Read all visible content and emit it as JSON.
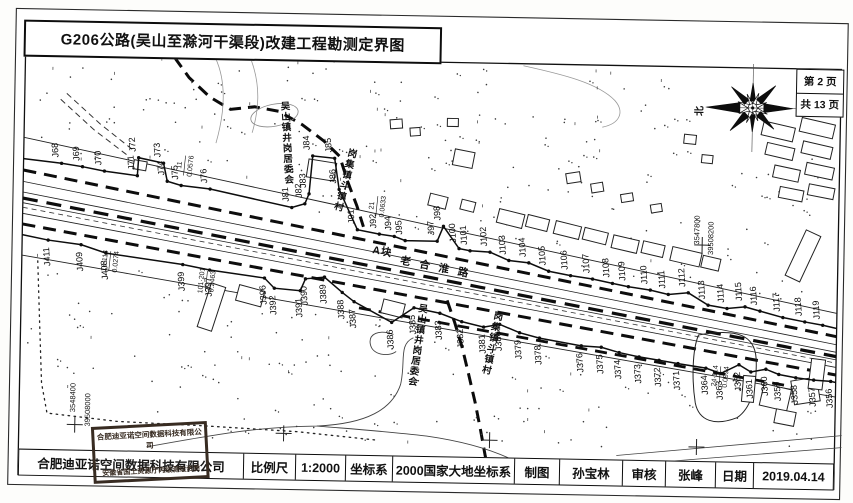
{
  "title": "G206公路(吴山至滁河干渠段)改建工程勘测定界图",
  "page_info": {
    "page": "第 2 页",
    "total": "共 13 页"
  },
  "north_label": "北",
  "footer": {
    "company": "合肥迪亚诺空间数据科技有限公司",
    "scale_label": "比例尺",
    "scale_value": "1:2000",
    "crs_label": "坐标系",
    "crs_value": "2000国家大地坐标系",
    "drafter_label": "制图",
    "drafter": "孙宝林",
    "reviewer_label": "审核",
    "reviewer": "张峰",
    "date_label": "日期",
    "date": "2019.04.14"
  },
  "stamp": {
    "line1": "合肥迪亚诺空间数据科技有限公司",
    "line2": "安徽省国土资源厅丙级测绘资质"
  },
  "map": {
    "block_label": "A块",
    "road_name": "老合淮路",
    "placenames": [
      {
        "text": "吴山镇井岗居委会",
        "x": 283,
        "y": 112,
        "step": 10.5,
        "rot": -4
      },
      {
        "text": "岗集镇斗镇村",
        "x": 350,
        "y": 158,
        "step": 11,
        "rot": 13
      },
      {
        "text": "吴山镇井岗居委会",
        "x": 424,
        "y": 312,
        "step": 10.5,
        "rot": 7
      },
      {
        "text": "岗集镇斗镇村",
        "x": 499,
        "y": 318,
        "step": 11,
        "rot": 11
      }
    ],
    "road_labels": [
      {
        "text": "A块",
        "x": 372,
        "y": 254,
        "rot": 9,
        "size": 10.5,
        "spacing": 1
      },
      {
        "text": "老合淮路",
        "x": 400,
        "y": 264,
        "rot": 10,
        "size": 10.5,
        "spacing": 9
      }
    ],
    "annotations": [
      {
        "num": "11",
        "area": "0.0576",
        "x": 183,
        "y": 170
      },
      {
        "num": "21",
        "area": "0.0633",
        "x": 376,
        "y": 207
      },
      {
        "num": "16·114",
        "area": "0.0274",
        "x": 110,
        "y": 267
      },
      {
        "num": "101·201",
        "area": "0.2463",
        "x": 207,
        "y": 285
      },
      {
        "num": "24·114",
        "area": "0.0994",
        "x": 722,
        "y": 371
      }
    ],
    "coord_labels": [
      {
        "text": "3548400",
        "x": 78,
        "y": 404
      },
      {
        "text": "39508000",
        "x": 93,
        "y": 416
      },
      {
        "text": "3547800",
        "x": 699,
        "y": 225
      },
      {
        "text": "39508200",
        "x": 713,
        "y": 233
      }
    ],
    "crosses": [
      [
        78,
        431
      ],
      [
        287,
        436
      ],
      [
        493,
        439
      ],
      [
        700,
        442
      ],
      [
        702,
        240
      ]
    ],
    "points_top": [
      [
        "J68",
        60,
        170
      ],
      [
        "J69",
        81,
        173
      ],
      [
        "J70",
        103,
        177
      ],
      [
        "J71",
        136,
        181
      ],
      [
        "J72",
        137,
        163
      ],
      [
        "J73",
        162,
        168
      ],
      [
        "J74",
        166,
        186
      ],
      [
        "J75",
        180,
        190
      ],
      [
        "J76",
        209,
        193
      ],
      [
        "J81",
        291,
        210
      ],
      [
        "J82",
        304,
        206
      ],
      [
        "J83",
        308,
        196
      ],
      [
        "J84",
        311,
        158
      ],
      [
        "J85",
        333,
        160
      ],
      [
        "J86",
        338,
        191
      ],
      [
        "J91",
        357,
        231
      ],
      [
        "J92",
        379,
        235
      ],
      [
        "J94",
        394,
        237
      ],
      [
        "J95",
        405,
        241
      ],
      [
        "J97",
        437,
        241
      ],
      [
        "J98",
        443,
        226
      ],
      [
        "J100",
        459,
        248
      ],
      [
        "J101",
        470,
        250
      ],
      [
        "J102",
        490,
        251
      ],
      [
        "J103",
        509,
        259
      ],
      [
        "J104",
        529,
        261
      ],
      [
        "J105",
        549,
        269
      ],
      [
        "J106",
        571,
        273
      ],
      [
        "J107",
        593,
        276
      ],
      [
        "J108",
        613,
        280
      ],
      [
        "J109",
        629,
        283
      ],
      [
        "J110",
        651,
        286
      ],
      [
        "J111",
        669,
        290
      ],
      [
        "J112",
        689,
        288
      ],
      [
        "J113",
        709,
        300
      ],
      [
        "J114",
        728,
        303
      ],
      [
        "J115",
        746,
        301
      ],
      [
        "J116",
        761,
        305
      ],
      [
        "J117",
        784,
        311
      ],
      [
        "J118",
        806,
        315
      ],
      [
        "J119",
        824,
        318
      ]
    ],
    "points_bottom": [
      [
        "J411",
        48,
        247
      ],
      [
        "J409",
        81,
        251
      ],
      [
        "J408",
        106,
        259
      ],
      [
        "J399",
        183,
        269
      ],
      [
        "J397",
        210,
        274
      ],
      [
        "J396",
        265,
        281
      ],
      [
        "J392",
        275,
        291
      ],
      [
        "J391",
        301,
        293
      ],
      [
        "J390",
        306,
        281
      ],
      [
        "J389",
        325,
        279
      ],
      [
        "J388",
        343,
        294
      ],
      [
        "J387",
        355,
        303
      ],
      [
        "J386",
        393,
        323
      ],
      [
        "J385",
        415,
        308
      ],
      [
        "J383",
        441,
        313
      ],
      [
        "J382",
        463,
        321
      ],
      [
        "J381",
        485,
        326
      ],
      [
        "J380",
        501,
        323
      ],
      [
        "J379",
        521,
        331
      ],
      [
        "J378",
        541,
        336
      ],
      [
        "J376",
        583,
        343
      ],
      [
        "J375",
        603,
        344
      ],
      [
        "J374",
        621,
        349
      ],
      [
        "J373",
        641,
        353
      ],
      [
        "J372",
        661,
        356
      ],
      [
        "J371",
        680,
        359
      ],
      [
        "J364",
        708,
        363
      ],
      [
        "J363",
        723,
        368
      ],
      [
        "J362",
        741,
        359
      ],
      [
        "J361",
        753,
        366
      ],
      [
        "J360",
        768,
        363
      ],
      [
        "J359",
        781,
        368
      ],
      [
        "J358",
        798,
        371
      ],
      [
        "J357",
        816,
        373
      ],
      [
        "J356",
        833,
        374
      ]
    ]
  }
}
